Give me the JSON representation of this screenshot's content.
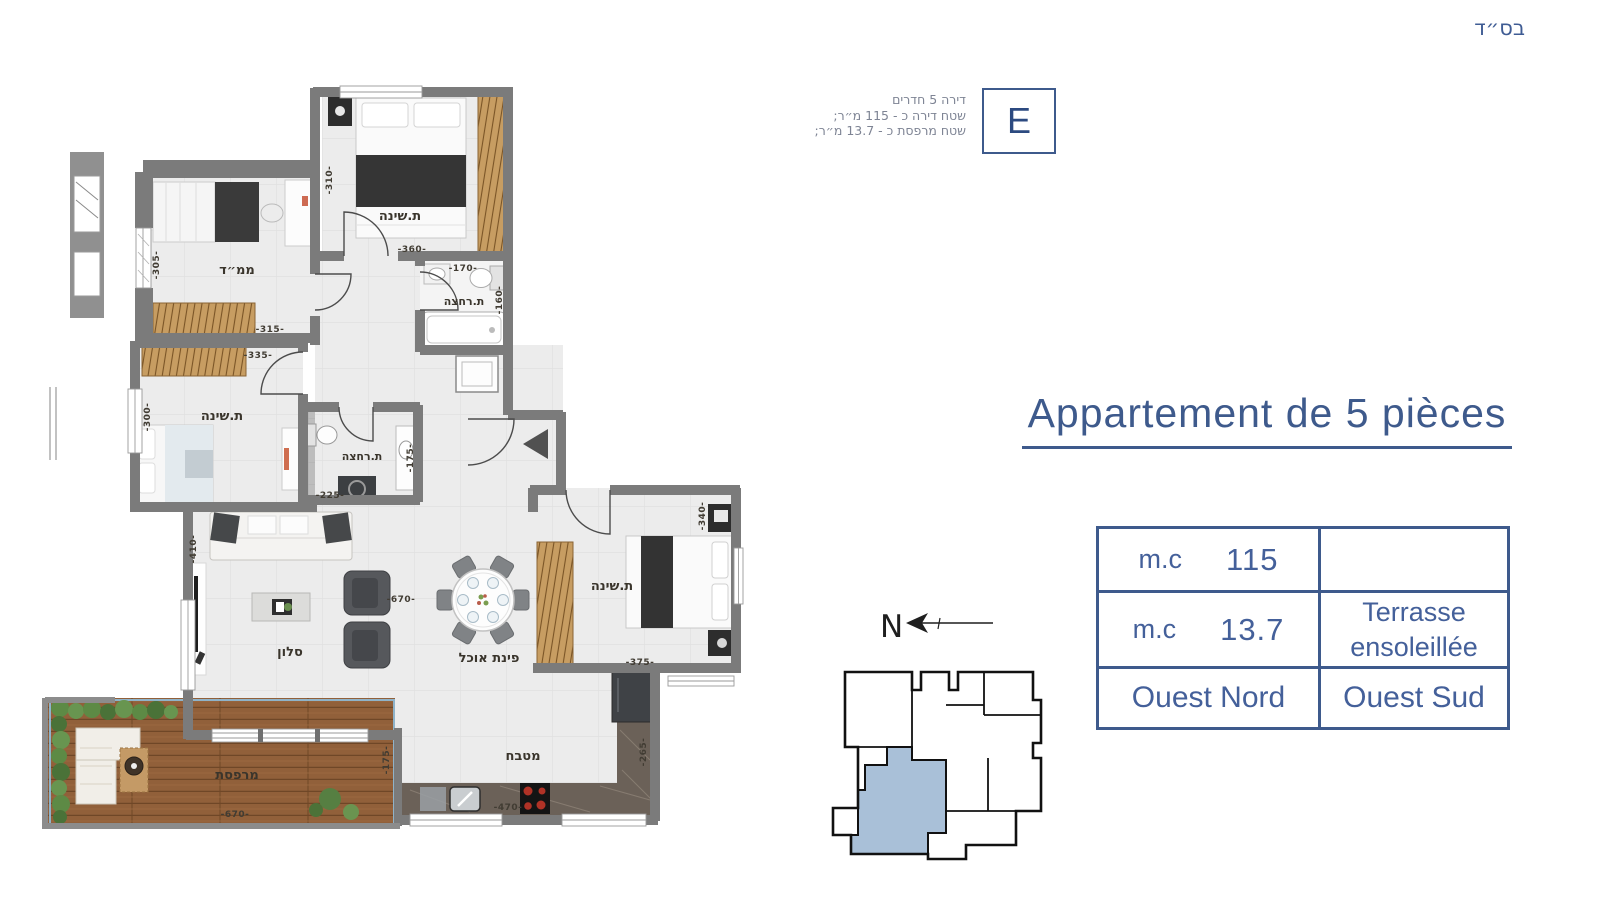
{
  "page": {
    "bsd": "בס״ד"
  },
  "unit_info": {
    "line1": "דירה 5 חדרים",
    "line2": "שטח דירה כ - 115 מ״ר;",
    "line3": "שטח מרפסת כ - 13.7 מ״ר;",
    "letter": "E"
  },
  "title": "Appartement de 5 pièces",
  "spec_table": {
    "apartment_area_label": "m.c",
    "apartment_area_value": "115",
    "apartment_desc": "",
    "terrace_area_label": "m.c",
    "terrace_area_value": "13.7",
    "terrace_desc_line1": "Terrasse",
    "terrace_desc_line2": "ensoleillée",
    "orientation_left": "Ouest Nord",
    "orientation_right": "Ouest Sud"
  },
  "compass": {
    "north_label": "N"
  },
  "plan": {
    "labels": {
      "bedroom_top": "ת.שינה",
      "bedroom_mid": "ת.שינה",
      "bedroom_right": "ת.שינה",
      "mamad": "ממ״ד",
      "bathroom_top": "ת.רחצה",
      "bathroom_mid": "ת.רחצה",
      "salon": "סלון",
      "dining": "פינת אוכל",
      "kitchen": "מטבח",
      "terrace": "מרפסת"
    },
    "dims": {
      "br1_w": "-360-",
      "br1_h": "-310-",
      "bath1_w": "-170-",
      "bath1_h": "-160-",
      "mamad_w": "-315-",
      "mamad_h": "-305-",
      "br2_w": "-335-",
      "br2_h": "-300-",
      "bath2_w": "-225-",
      "bath2_h": "-175-",
      "living_w": "-670-",
      "living_h": "-410-",
      "br3_w": "-375-",
      "br3_h": "-340-",
      "kitchen_w": "-470-",
      "kitchen_h": "-265-",
      "terrace_w": "-670-",
      "terrace_h": "-175-"
    }
  },
  "colors": {
    "accent": "#3e5a8c",
    "wall": "#7b7b7b",
    "highlight_unit": "#a9c0d8",
    "closet_wood": "#c79d62",
    "terrace_deck": "#91603a"
  }
}
